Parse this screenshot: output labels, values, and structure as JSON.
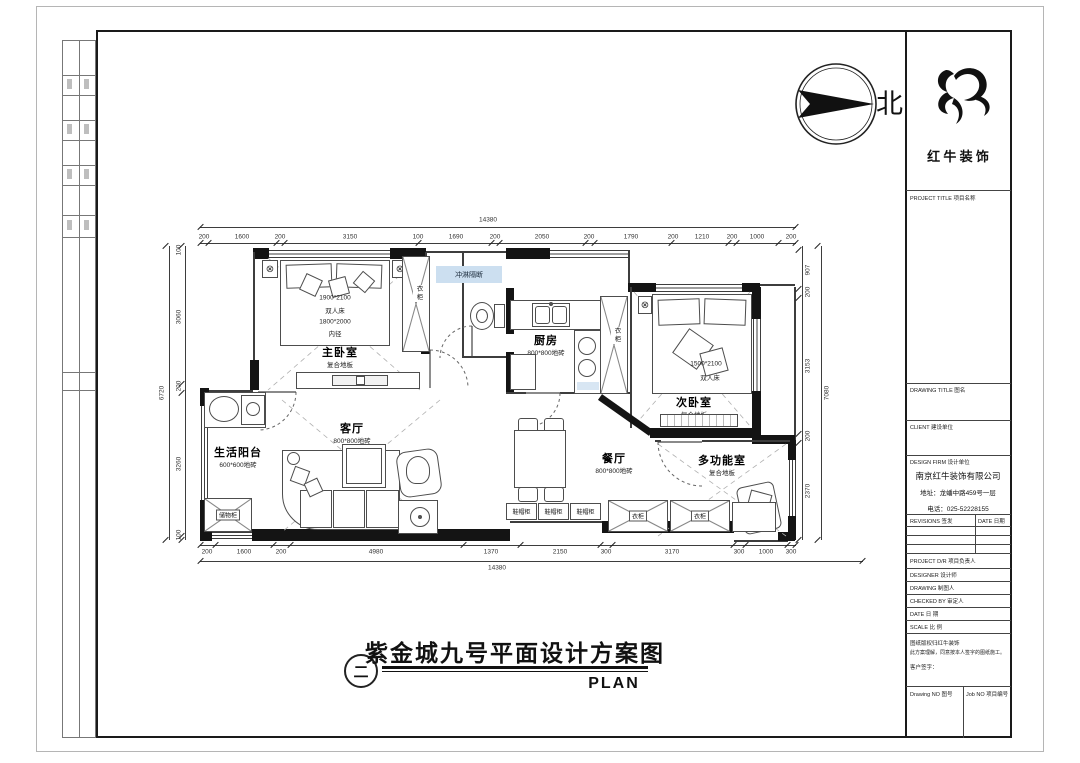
{
  "north": {
    "label": "北"
  },
  "logo": {
    "company": "红 牛 装 饰"
  },
  "title_block": {
    "project_title": "PROJECT TITLE  项目名称",
    "drawing_title": "DRAWING TITLE  图名",
    "client": "CLIENT  建设单位",
    "design_firm": "DESIGN FIRM  设计单位",
    "firm_name": "南京红牛装饰有限公司",
    "firm_address": "地址：龙蟠中路459号一层",
    "firm_phone": "电话：025-52228155",
    "revisions": "REVISIONS  签发",
    "date_col": "DATE  日期",
    "project_dr": "PROJECT D/R  项目负责人",
    "designer": "DESIGNER  设计师",
    "drawing_by": "DRAWING  制图人",
    "checked_by": "CHECKED BY  审定人",
    "date": "DATE  日  期",
    "scale": "SCALE  比  例",
    "note_line1": "图纸版权归红牛装饰",
    "note_line2": "此方案理解，同意按本人签字的图纸施工。",
    "note_line3": "客户签字：",
    "drawing_no": "Drawing NO  图号",
    "job_no": "Job NO  项目编号"
  },
  "plan": {
    "rooms": {
      "master": {
        "name": "主卧室",
        "floor": "复合地板",
        "bed1": "1900*2100",
        "bed2": "双人床",
        "bed3": "1800*2000",
        "bed4": "内径"
      },
      "living": {
        "name": "客厅",
        "floor": "800*800地砖"
      },
      "balcony": {
        "name": "生活阳台",
        "floor": "600*600地砖"
      },
      "kitchen": {
        "name": "厨房",
        "floor": "800*800地砖"
      },
      "dining": {
        "name": "餐厅",
        "floor": "800*800地砖"
      },
      "second": {
        "name": "次卧室",
        "floor": "复合地板",
        "bed1": "1500*2100",
        "bed2": "双人床"
      },
      "multi": {
        "name": "多功能室",
        "floor": "复合地板"
      }
    },
    "cabinets": {
      "wardrobe": "衣柜",
      "storage": "储物柜",
      "shoe": "鞋帽柜",
      "shower_partition": "冲淋隔断"
    },
    "icons": {
      "lamp": "⊗"
    },
    "dims": {
      "top_total": "14380",
      "top": [
        "200",
        "1600",
        "200",
        "3150",
        "100",
        "1690",
        "200",
        "2050",
        "200",
        "1790",
        "200",
        "1210",
        "200",
        "1000",
        "200"
      ],
      "bottom_total": "14380",
      "bottom": [
        "200",
        "1600",
        "200",
        "4980",
        "1370",
        "2150",
        "300",
        "3170",
        "300",
        "1000",
        "300"
      ],
      "left_total": "6720",
      "left": [
        "100",
        "3060",
        "200",
        "3260",
        "100"
      ],
      "right_total": "7080",
      "right": [
        "907",
        "200",
        "3153",
        "200",
        "2370"
      ]
    }
  },
  "footer": {
    "index": "二",
    "title": "紫金城九号平面设计方案图",
    "plan_label": "PLAN"
  }
}
